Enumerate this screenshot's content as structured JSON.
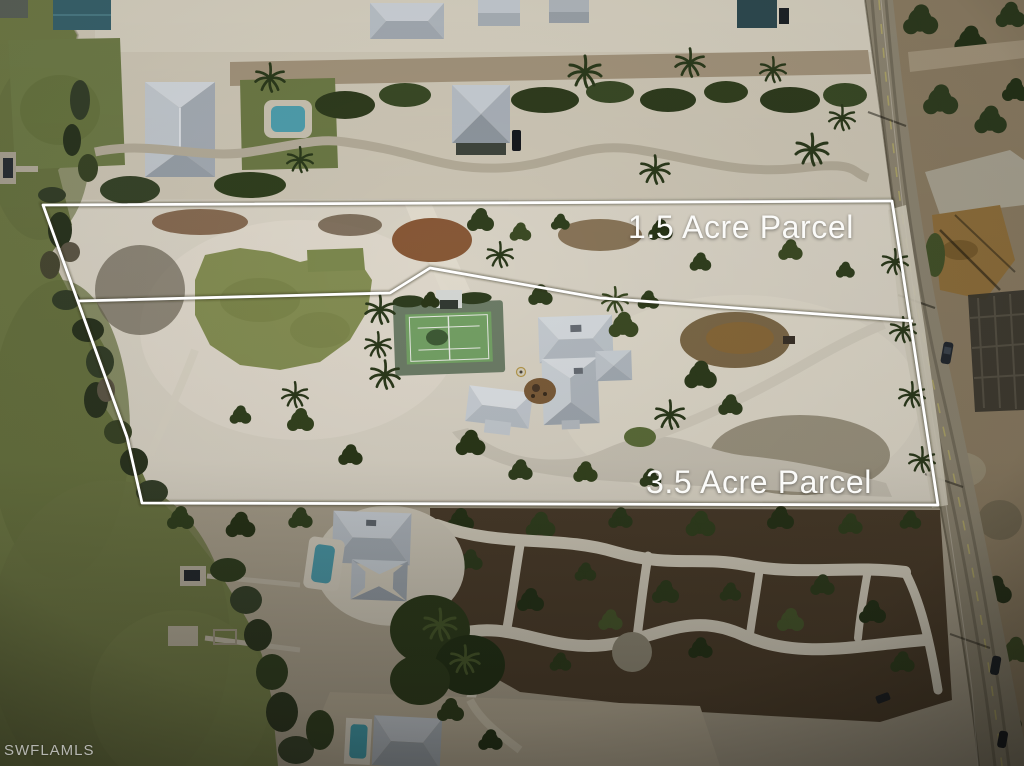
{
  "annotations": {
    "top_parcel_label": "1.5 Acre Parcel",
    "bottom_parcel_label": "3.5 Acre Parcel"
  },
  "watermark": "SWFLAMLS",
  "colors": {
    "boundary_line": "#ffffff",
    "label_text": "#fbfbf9",
    "watermark_text": "#cbcbc9",
    "water": "#6f7a46",
    "sand": "#d8d2c3",
    "vegetation": "#33401f",
    "mulch": "#46382a",
    "road": "#8e8673",
    "roof": "#c9ced4",
    "pool": "#4f9aa8",
    "tennis_court": "#76a467",
    "lawn": "#879155"
  }
}
